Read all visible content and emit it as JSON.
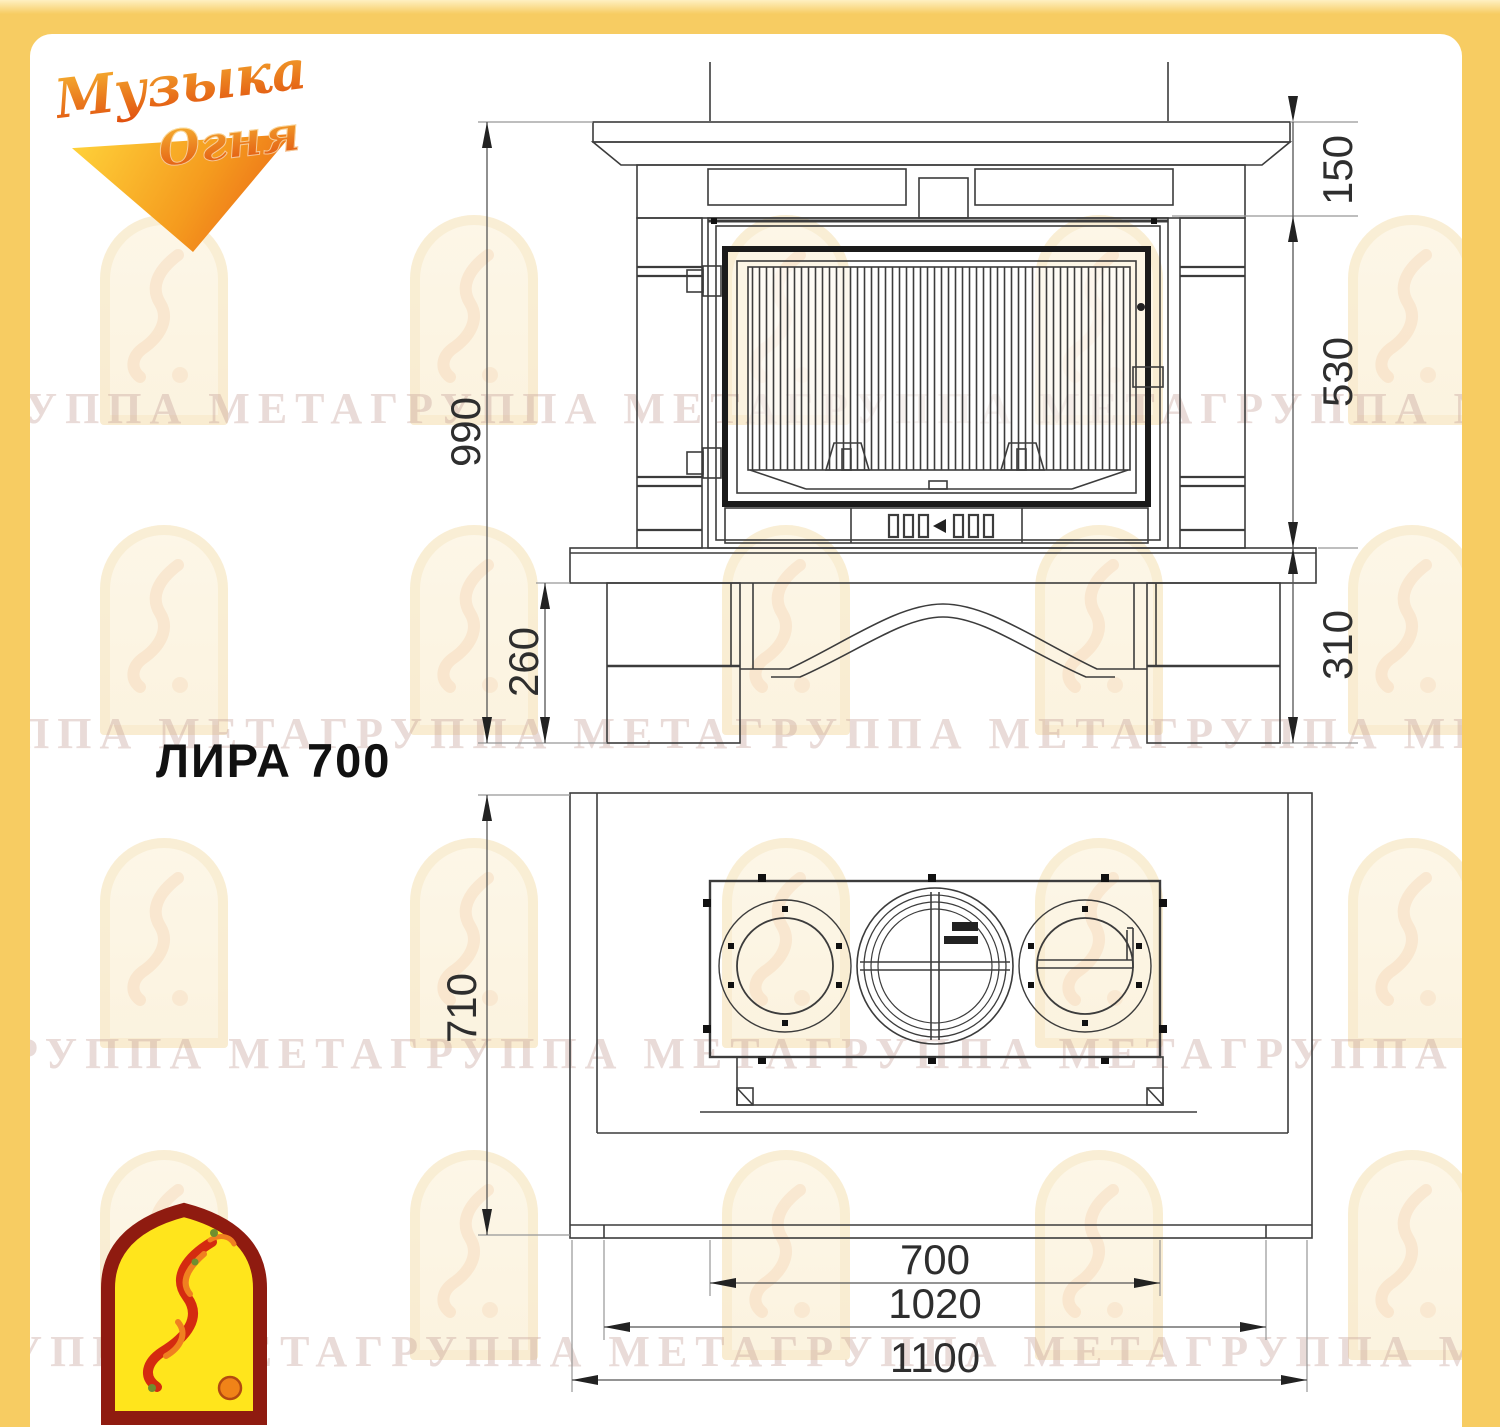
{
  "branding": {
    "logo_word1": "Музыка",
    "logo_word2": "Огня"
  },
  "title": "ЛИРА 700",
  "watermark": {
    "pattern": "ГРУППА МЕТАГРУППА МЕТАГРУППА МЕТАГРУППА МЕТА "
  },
  "colors": {
    "frame_yellow": "#F7CC62",
    "line_dark": "#3c3c3c",
    "logo_red": "#8F1B10",
    "logo_yellow": "#FFE51C"
  },
  "views": {
    "front": {
      "label": "front-elevation",
      "dims": {
        "overall_height": "990",
        "mantel_height": "150",
        "firebox_height": "530",
        "hearth_to_floor": "310",
        "base_height": "260"
      }
    },
    "plan": {
      "label": "plan-view",
      "dims": {
        "depth": "710",
        "firebox_width": "700",
        "body_width": "1020",
        "overall_width": "1100"
      }
    }
  }
}
